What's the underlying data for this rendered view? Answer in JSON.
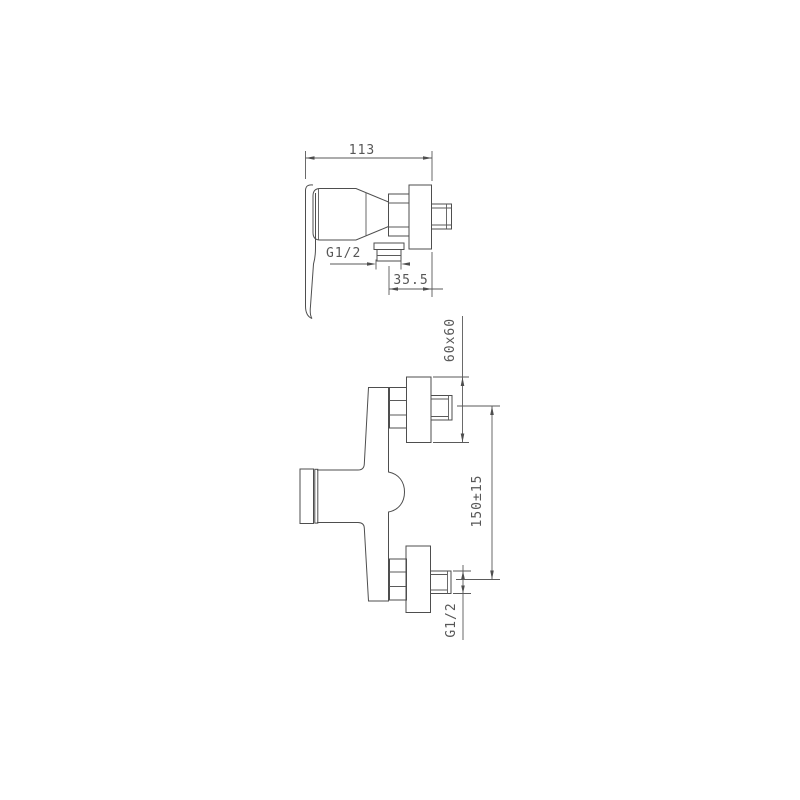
{
  "page": {
    "background_color": "#ffffff",
    "line_color": "#4e4e4e",
    "text_color": "#575757",
    "drawing_subject": "wall-mounted shower mixer tap, two orthographic views"
  },
  "side_view": {
    "width_dim": "113",
    "outlet_thread_label": "G1/2",
    "outlet_offset_dim": "35.5"
  },
  "front_view": {
    "escutcheon_dim": "60x60",
    "inlet_spacing_dim": "150±15",
    "inlet_thread_label": "G1/2"
  }
}
